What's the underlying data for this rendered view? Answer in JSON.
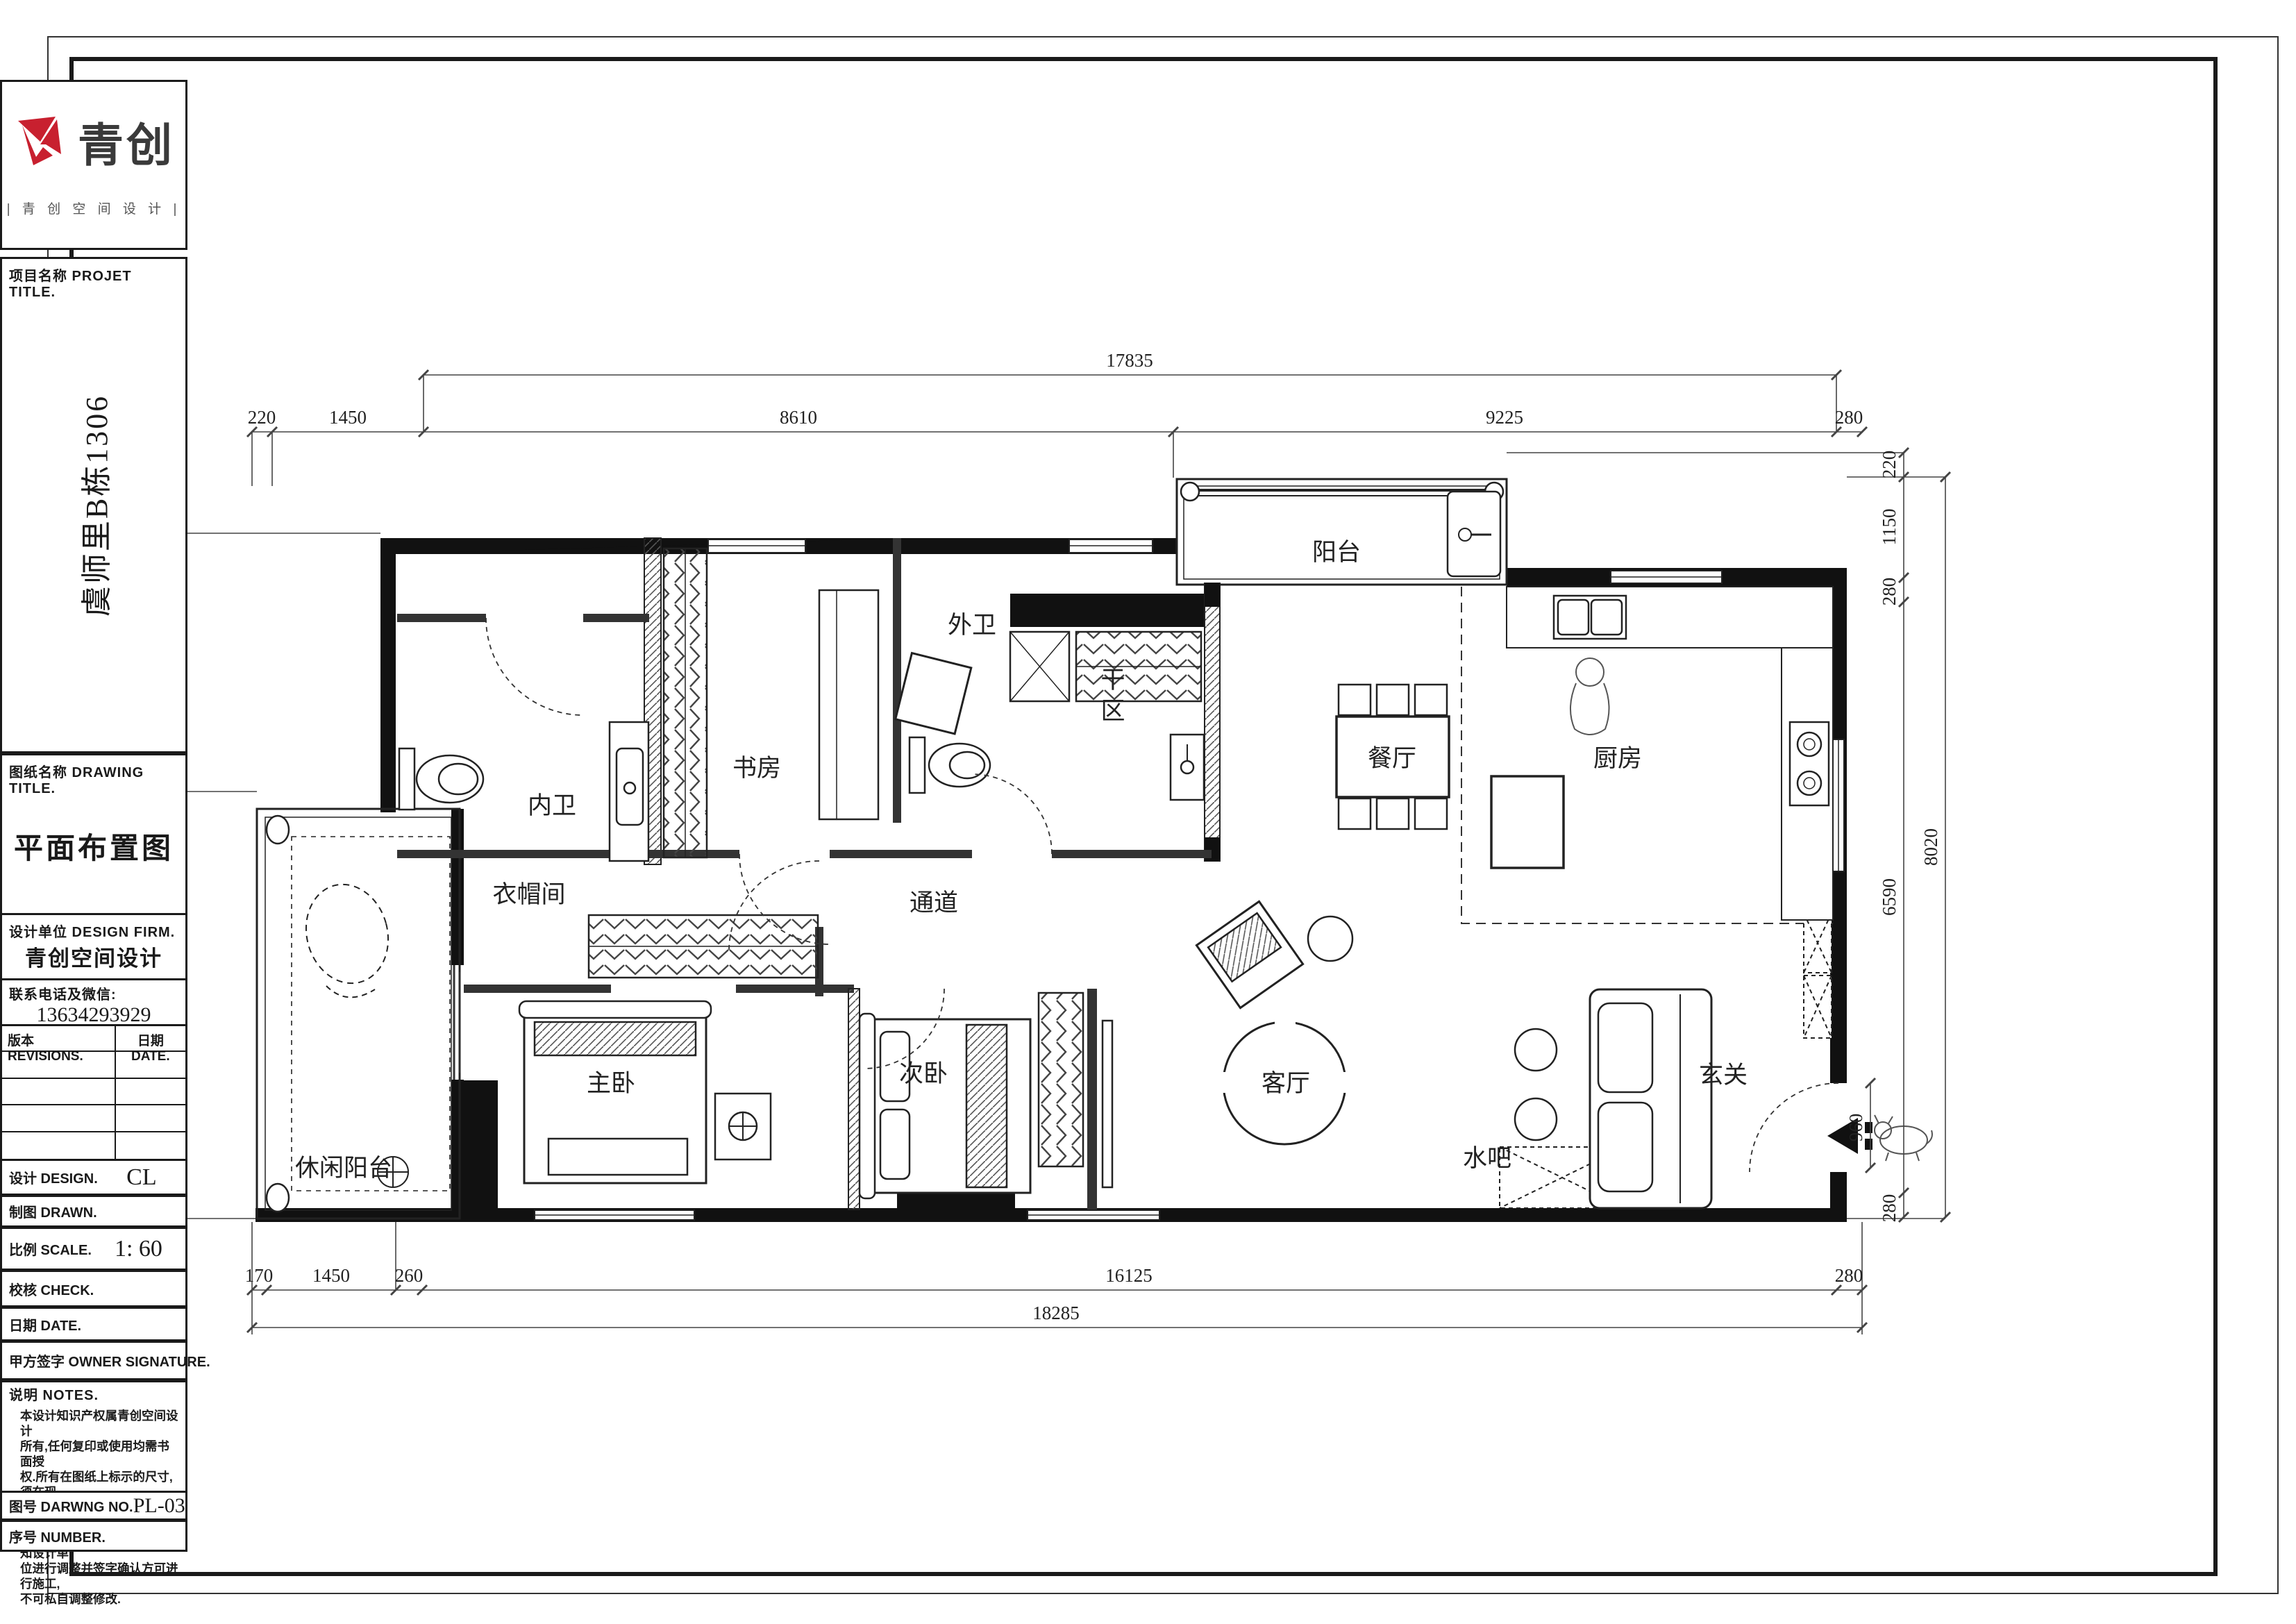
{
  "logo": {
    "brand": "青创",
    "tagline": "| 青  创  空  间  设  计 |",
    "accent_color": "#c8202f"
  },
  "title_block": {
    "project_label": "项目名称 PROJET TITLE.",
    "project_name": "虞师里B栋1306",
    "drawing_label": "图纸名称 DRAWING TITLE.",
    "drawing_name": "平面布置图",
    "firm_label": "设计单位 DESIGN FIRM.",
    "firm_name": "青创空间设计",
    "contact_label": "联系电话及微信:",
    "contact_value": "13634293929",
    "revisions_label": "版本 REVISIONS.",
    "rev_date_label": "日期 DATE.",
    "design_label": "设计 DESIGN.",
    "design_value": "CL",
    "drawn_label": "制图 DRAWN.",
    "drawn_value": "",
    "scale_label": "比例 SCALE.",
    "scale_value": "1: 60",
    "check_label": "校核 CHECK.",
    "check_value": "",
    "date_label": "日期 DATE.",
    "date_value": "",
    "owner_label": "甲方签字 OWNER SIGNATURE.",
    "notes_label": "说明 NOTES.",
    "notes_lines": [
      "本设计知识产权属青创空间设计",
      "所有,任何复印或使用均需书面授",
      "权.所有在图纸上标示的尺寸,须在现",
      "场复合及修正.如遇图纸标示不清;图",
      "纸尺寸与现场不符,请立即通知设计单",
      "位进行调整并签字确认方可进行施工,",
      "不可私自调整修改."
    ],
    "drawing_no_label": "图号 DARWNG NO.",
    "drawing_no_value": "PL-03",
    "number_label": "序号 NUMBER.",
    "number_value": ""
  },
  "plan": {
    "rooms": [
      {
        "id": "balcony",
        "label": "阳台"
      },
      {
        "id": "guest-bath",
        "label": "外卫"
      },
      {
        "id": "dry-area",
        "label": "干区"
      },
      {
        "id": "master-bath",
        "label": "内卫"
      },
      {
        "id": "study",
        "label": "书房"
      },
      {
        "id": "dining",
        "label": "餐厅"
      },
      {
        "id": "kitchen",
        "label": "厨房"
      },
      {
        "id": "cloakroom",
        "label": "衣帽间"
      },
      {
        "id": "corridor",
        "label": "通道"
      },
      {
        "id": "master-bedroom",
        "label": "主卧"
      },
      {
        "id": "leisure-balcony",
        "label": "休闲阳台"
      },
      {
        "id": "second-bedroom",
        "label": "次卧"
      },
      {
        "id": "living-room",
        "label": "客厅"
      },
      {
        "id": "water-bar",
        "label": "水吧"
      },
      {
        "id": "entry",
        "label": "玄关"
      }
    ],
    "dims": {
      "top_total": "17835",
      "top_chain": [
        "220",
        "1450",
        "8610",
        "9225",
        "280"
      ],
      "bottom_chain": [
        "170",
        "1450",
        "260",
        "16125",
        "280"
      ],
      "bottom_total": "18285",
      "left_total": "7160",
      "left_chain": [
        "280",
        "2950",
        "4210",
        "280"
      ],
      "right_total": "8020",
      "right_chain": [
        "220",
        "1150",
        "280",
        "6590",
        "280"
      ],
      "entry_dim": "960"
    }
  }
}
